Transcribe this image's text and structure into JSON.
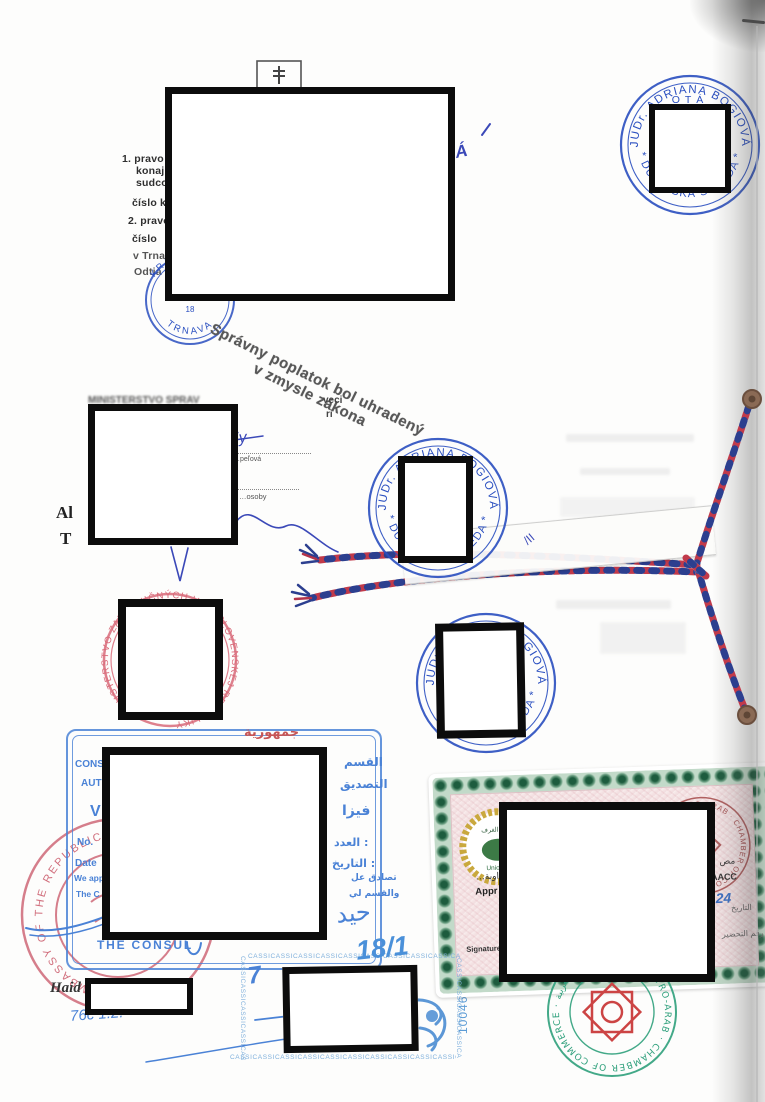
{
  "document": {
    "kind": "scanned legalized court document with notarial binding and consular stamps"
  },
  "top_text": {
    "lines": [
      "1. pravo",
      "konaj",
      "sudco",
      "číslo k",
      "2. pravo",
      "číslo",
      "v Trna",
      "Odtia"
    ]
  },
  "handwriting": {
    "va": "VÁ",
    "sticker_mark": "/II"
  },
  "fee_note": {
    "line1": "Správny poplatok bol uhradený",
    "line2": "v zmysle zákona"
  },
  "notary_stamp": {
    "name": "JUDr. ADRIANA BOGIOVÁ",
    "city": "* DUNAJSKÁ STREDA *",
    "inner": "OTÁ"
  },
  "court_stamp": {
    "top": "KRAJSKÝ SÚD",
    "bottom": "TRNAVA",
    "number": "18"
  },
  "ministry": {
    "header_blur": "MINISTERSTVO SPRAV",
    "frag1": "veci",
    "frag2": "ri",
    "sig": "Zy",
    "dotted1": "…peľová",
    "dotted2": "…osoby",
    "left1": "Al",
    "left2": "T"
  },
  "red_stamp": {
    "ring": "MINISTERSTVO ZAHRANIČNÝCH VECÍ SLOVENSKEJ REPUBLIKY"
  },
  "embassy": {
    "ring": "EMBASSY OF THE REPUBLIC"
  },
  "consular": {
    "top_arabic": "جمهورية",
    "left": {
      "l1": "CONS",
      "l2": "AUT",
      "big": "V",
      "no": "No.",
      "date": "Date",
      "f1": "We app",
      "f2": "The C"
    },
    "right": {
      "r1": "القسم",
      "r2": "التصديق",
      "big": "فيزا",
      "no": "العدد :",
      "date": "التاريخ :",
      "f1": "تصادق عل",
      "f2": "والقسم لي"
    },
    "consul": "THE CONSUL",
    "haidar": "حيد"
  },
  "bottom": {
    "haid": "Haid",
    "scribble": "76c 1.2.",
    "n181": "18/1",
    "seven": "7",
    "cass": "CASSICASSICASSICASSICASSICASSICASSICASSICASSICASSICASSICASS",
    "vnum": "10046"
  },
  "certificate": {
    "union_top": "اتحاد الغرف",
    "union_label": "Union of",
    "aacc_ring": "· AUSTRO-ARAB · CHAMBER OF COMMERCE",
    "frag_ar": "…اوية",
    "appr": "Appr",
    "frag_ar2": "مص",
    "acc": "AACC",
    "num24": "24",
    "date_lbl": "التاريخ",
    "prep_lbl": "رقم التحضير",
    "sig_lbl": "Signature -"
  },
  "chamber_stamp": {
    "ring": "AUSTRO-ARAB · CHAMBER OF COMMERCE · غرفة التجارة النمساوية العربية"
  },
  "colors": {
    "notary_blue": "#2a4fc0",
    "consular_blue": "#4a82d6",
    "pen_blue": "#3b49b8",
    "red_stamp": "#d96b7a",
    "embassy_red": "#cc5f6f",
    "chamber_green": "#2fa07c",
    "cert_green": "#1d5c3e",
    "cert_red": "#b06060",
    "cass_blue": "#7fb0dc",
    "cord_red": "#c13a4a",
    "cord_blue": "#2c3f8f"
  }
}
